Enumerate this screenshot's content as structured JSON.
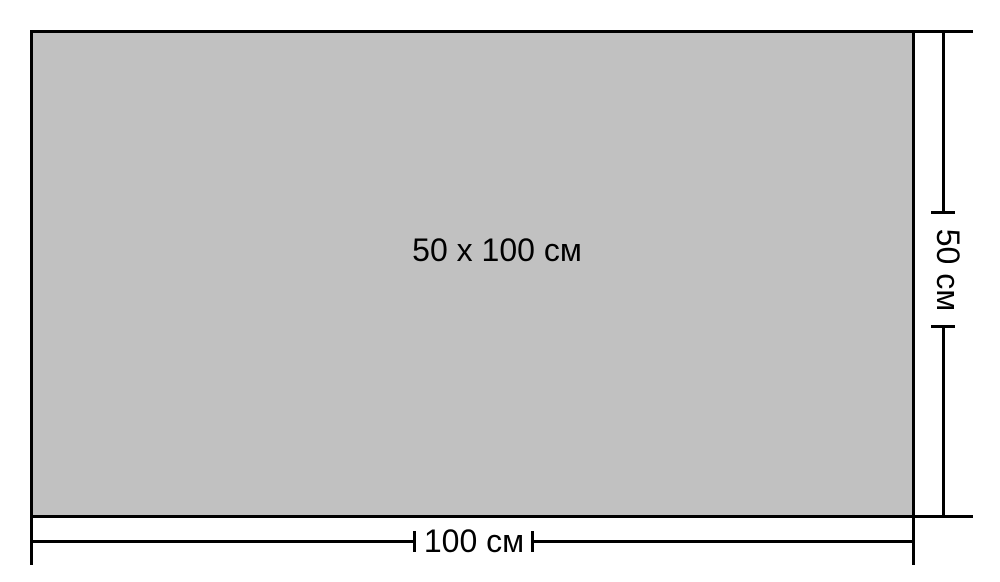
{
  "diagram": {
    "panel_label": "50 x 100 см",
    "width_dimension": {
      "label": "100 см",
      "value_cm": 100
    },
    "height_dimension": {
      "label": "50 см",
      "value_cm": 50
    },
    "colors": {
      "panel_fill": "#c1c1c1",
      "line_color": "#000000",
      "background": "#ffffff",
      "text_color": "#000000"
    }
  }
}
